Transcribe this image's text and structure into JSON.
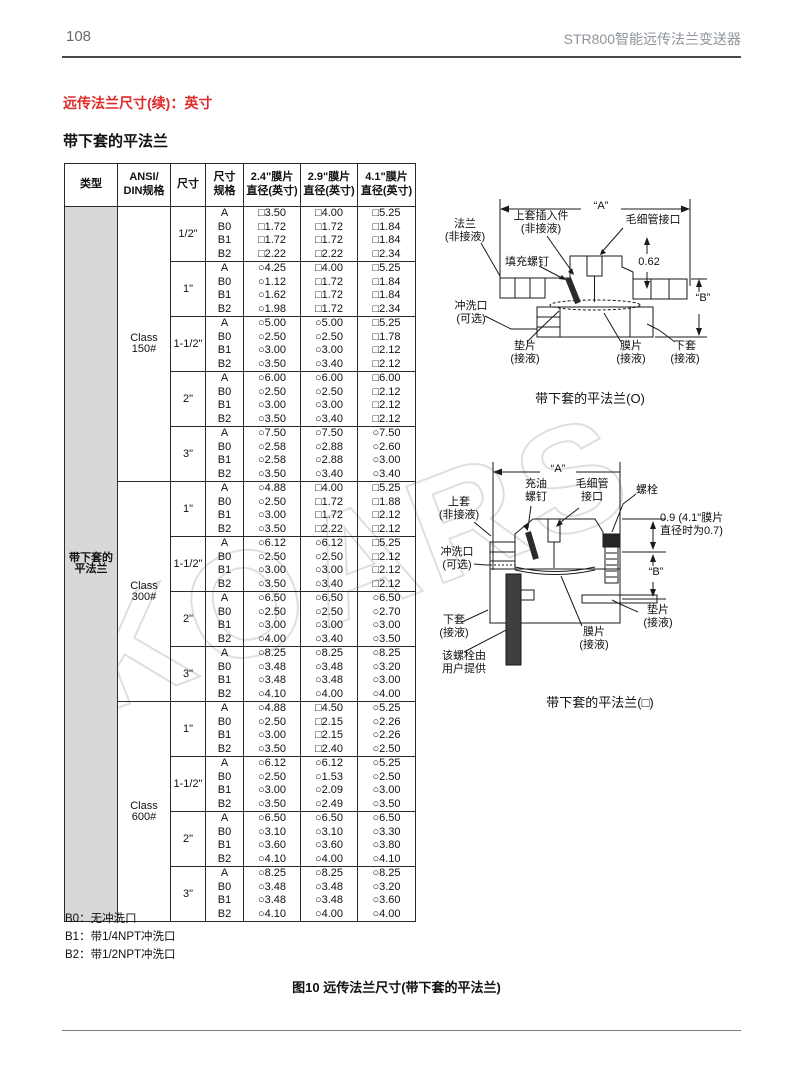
{
  "page": {
    "number": "108",
    "header_right": "STR800智能远传法兰变送器",
    "section_title": "远传法兰尺寸(续)：英寸",
    "subsection_title": "带下套的平法兰",
    "figure_caption": "图10 远传法兰尺寸(带下套的平法兰)",
    "watermark": "KOARS"
  },
  "table": {
    "headers": [
      "类型",
      "ANSI/\nDIN规格",
      "尺寸",
      "尺寸\n规格",
      "2.4\"膜片\n直径(英寸)",
      "2.9\"膜片\n直径(英寸)",
      "4.1\"膜片\n直径(英寸)"
    ],
    "type_label": "带下套的\n平法兰",
    "classes": [
      {
        "label": "Class\n150#",
        "sizes": [
          {
            "size": "1/2\"",
            "rows": [
              [
                "A",
                "□3.50",
                "□4.00",
                "□5.25"
              ],
              [
                "B0",
                "□1.72",
                "□1.72",
                "□1.84"
              ],
              [
                "B1",
                "□1.72",
                "□1.72",
                "□1.84"
              ],
              [
                "B2",
                "□2.22",
                "□2.22",
                "□2.34"
              ]
            ]
          },
          {
            "size": "1\"",
            "rows": [
              [
                "A",
                "○4.25",
                "□4.00",
                "□5.25"
              ],
              [
                "B0",
                "○1.12",
                "□1.72",
                "□1.84"
              ],
              [
                "B1",
                "○1.62",
                "□1.72",
                "□1.84"
              ],
              [
                "B2",
                "○1.98",
                "□1.72",
                "□2.34"
              ]
            ]
          },
          {
            "size": "1-1/2\"",
            "rows": [
              [
                "A",
                "○5.00",
                "○5.00",
                "□5.25"
              ],
              [
                "B0",
                "○2.50",
                "○2.50",
                "□1.78"
              ],
              [
                "B1",
                "○3.00",
                "○3.00",
                "□2.12"
              ],
              [
                "B2",
                "○3.50",
                "○3.40",
                "□2.12"
              ]
            ]
          },
          {
            "size": "2\"",
            "rows": [
              [
                "A",
                "○6.00",
                "○6.00",
                "□6.00"
              ],
              [
                "B0",
                "○2.50",
                "○2.50",
                "□2.12"
              ],
              [
                "B1",
                "○3.00",
                "○3.00",
                "□2.12"
              ],
              [
                "B2",
                "○3.50",
                "○3.40",
                "□2.12"
              ]
            ]
          },
          {
            "size": "3\"",
            "rows": [
              [
                "A",
                "○7.50",
                "○7.50",
                "○7.50"
              ],
              [
                "B0",
                "○2.58",
                "○2.88",
                "○2.60"
              ],
              [
                "B1",
                "○2.58",
                "○2.88",
                "○3.00"
              ],
              [
                "B2",
                "○3.50",
                "○3.40",
                "○3.40"
              ]
            ]
          }
        ]
      },
      {
        "label": "Class\n300#",
        "sizes": [
          {
            "size": "1\"",
            "rows": [
              [
                "A",
                "○4.88",
                "□4.00",
                "□5.25"
              ],
              [
                "B0",
                "○2.50",
                "□1.72",
                "□1.88"
              ],
              [
                "B1",
                "○3.00",
                "□1.72",
                "□2.12"
              ],
              [
                "B2",
                "○3.50",
                "□2.22",
                "□2.12"
              ]
            ]
          },
          {
            "size": "1-1/2\"",
            "rows": [
              [
                "A",
                "○6.12",
                "○6.12",
                "□5.25"
              ],
              [
                "B0",
                "○2.50",
                "○2.50",
                "□2.12"
              ],
              [
                "B1",
                "○3.00",
                "○3.00",
                "□2.12"
              ],
              [
                "B2",
                "○3.50",
                "○3.40",
                "□2.12"
              ]
            ]
          },
          {
            "size": "2\"",
            "rows": [
              [
                "A",
                "○6.50",
                "○6.50",
                "○6.50"
              ],
              [
                "B0",
                "○2.50",
                "○2.50",
                "○2.70"
              ],
              [
                "B1",
                "○3.00",
                "○3.00",
                "○3.00"
              ],
              [
                "B2",
                "○4.00",
                "○3.40",
                "○3.50"
              ]
            ]
          },
          {
            "size": "3\"",
            "rows": [
              [
                "A",
                "○8.25",
                "○8.25",
                "○8.25"
              ],
              [
                "B0",
                "○3.48",
                "○3.48",
                "○3.20"
              ],
              [
                "B1",
                "○3.48",
                "○3.48",
                "○3.00"
              ],
              [
                "B2",
                "○4.10",
                "○4.00",
                "○4.00"
              ]
            ]
          }
        ]
      },
      {
        "label": "Class\n600#",
        "sizes": [
          {
            "size": "1\"",
            "rows": [
              [
                "A",
                "○4.88",
                "□4.50",
                "○5.25"
              ],
              [
                "B0",
                "○2.50",
                "□2.15",
                "○2.26"
              ],
              [
                "B1",
                "○3.00",
                "□2.15",
                "○2.26"
              ],
              [
                "B2",
                "○3.50",
                "□2.40",
                "○2.50"
              ]
            ]
          },
          {
            "size": "1-1/2\"",
            "rows": [
              [
                "A",
                "○6.12",
                "○6.12",
                "○5.25"
              ],
              [
                "B0",
                "○2.50",
                "○1.53",
                "○2.50"
              ],
              [
                "B1",
                "○3.00",
                "○2.09",
                "○3.00"
              ],
              [
                "B2",
                "○3.50",
                "○2.49",
                "○3.50"
              ]
            ]
          },
          {
            "size": "2\"",
            "rows": [
              [
                "A",
                "○6.50",
                "○6.50",
                "○6.50"
              ],
              [
                "B0",
                "○3.10",
                "○3.10",
                "○3.30"
              ],
              [
                "B1",
                "○3.60",
                "○3.60",
                "○3.80"
              ],
              [
                "B2",
                "○4.10",
                "○4.00",
                "○4.10"
              ]
            ]
          },
          {
            "size": "3\"",
            "rows": [
              [
                "A",
                "○8.25",
                "○8.25",
                "○8.25"
              ],
              [
                "B0",
                "○3.48",
                "○3.48",
                "○3.20"
              ],
              [
                "B1",
                "○3.48",
                "○3.48",
                "○3.60"
              ],
              [
                "B2",
                "○4.10",
                "○4.00",
                "○4.00"
              ]
            ]
          }
        ]
      }
    ]
  },
  "notes": [
    "B0：无冲洗口",
    "B1：带1/4NPT冲洗口",
    "B2：带1/2NPT冲洗口"
  ],
  "diagram_top": {
    "caption": "带下套的平法兰(O)",
    "labels": {
      "dim_a": "“A”",
      "flange": "法兰\n(非接液)",
      "insert": "上套插入件\n(非接液)",
      "capillary": "毛细管接口",
      "fill_screw": "填充螺钉",
      "dim_062": "0.62",
      "dim_b": "“B”",
      "flush_port": "冲洗口\n(可选)",
      "gasket": "垫片\n(接液)",
      "diaphragm": "膜片\n(接液)",
      "lower_sleeve": "下套\n(接液)"
    }
  },
  "diagram_bottom": {
    "caption": "带下套的平法兰(□)",
    "labels": {
      "dim_a": "“A”",
      "oil_screw": "充油\n螺钉",
      "capillary": "毛细管\n接口",
      "bolt": "螺栓",
      "upper_sleeve": "上套\n(非接液)",
      "flush_port": "冲洗口\n(可选)",
      "dim_09": "0.9 (4.1\"膜片\n直径时为0.7)",
      "dim_b": "“B”",
      "lower_sleeve": "下套\n(接液)",
      "user_bolt": "该螺栓由\n用户提供",
      "diaphragm": "膜片\n(接液)",
      "gasket": "垫片\n(接液)"
    }
  }
}
